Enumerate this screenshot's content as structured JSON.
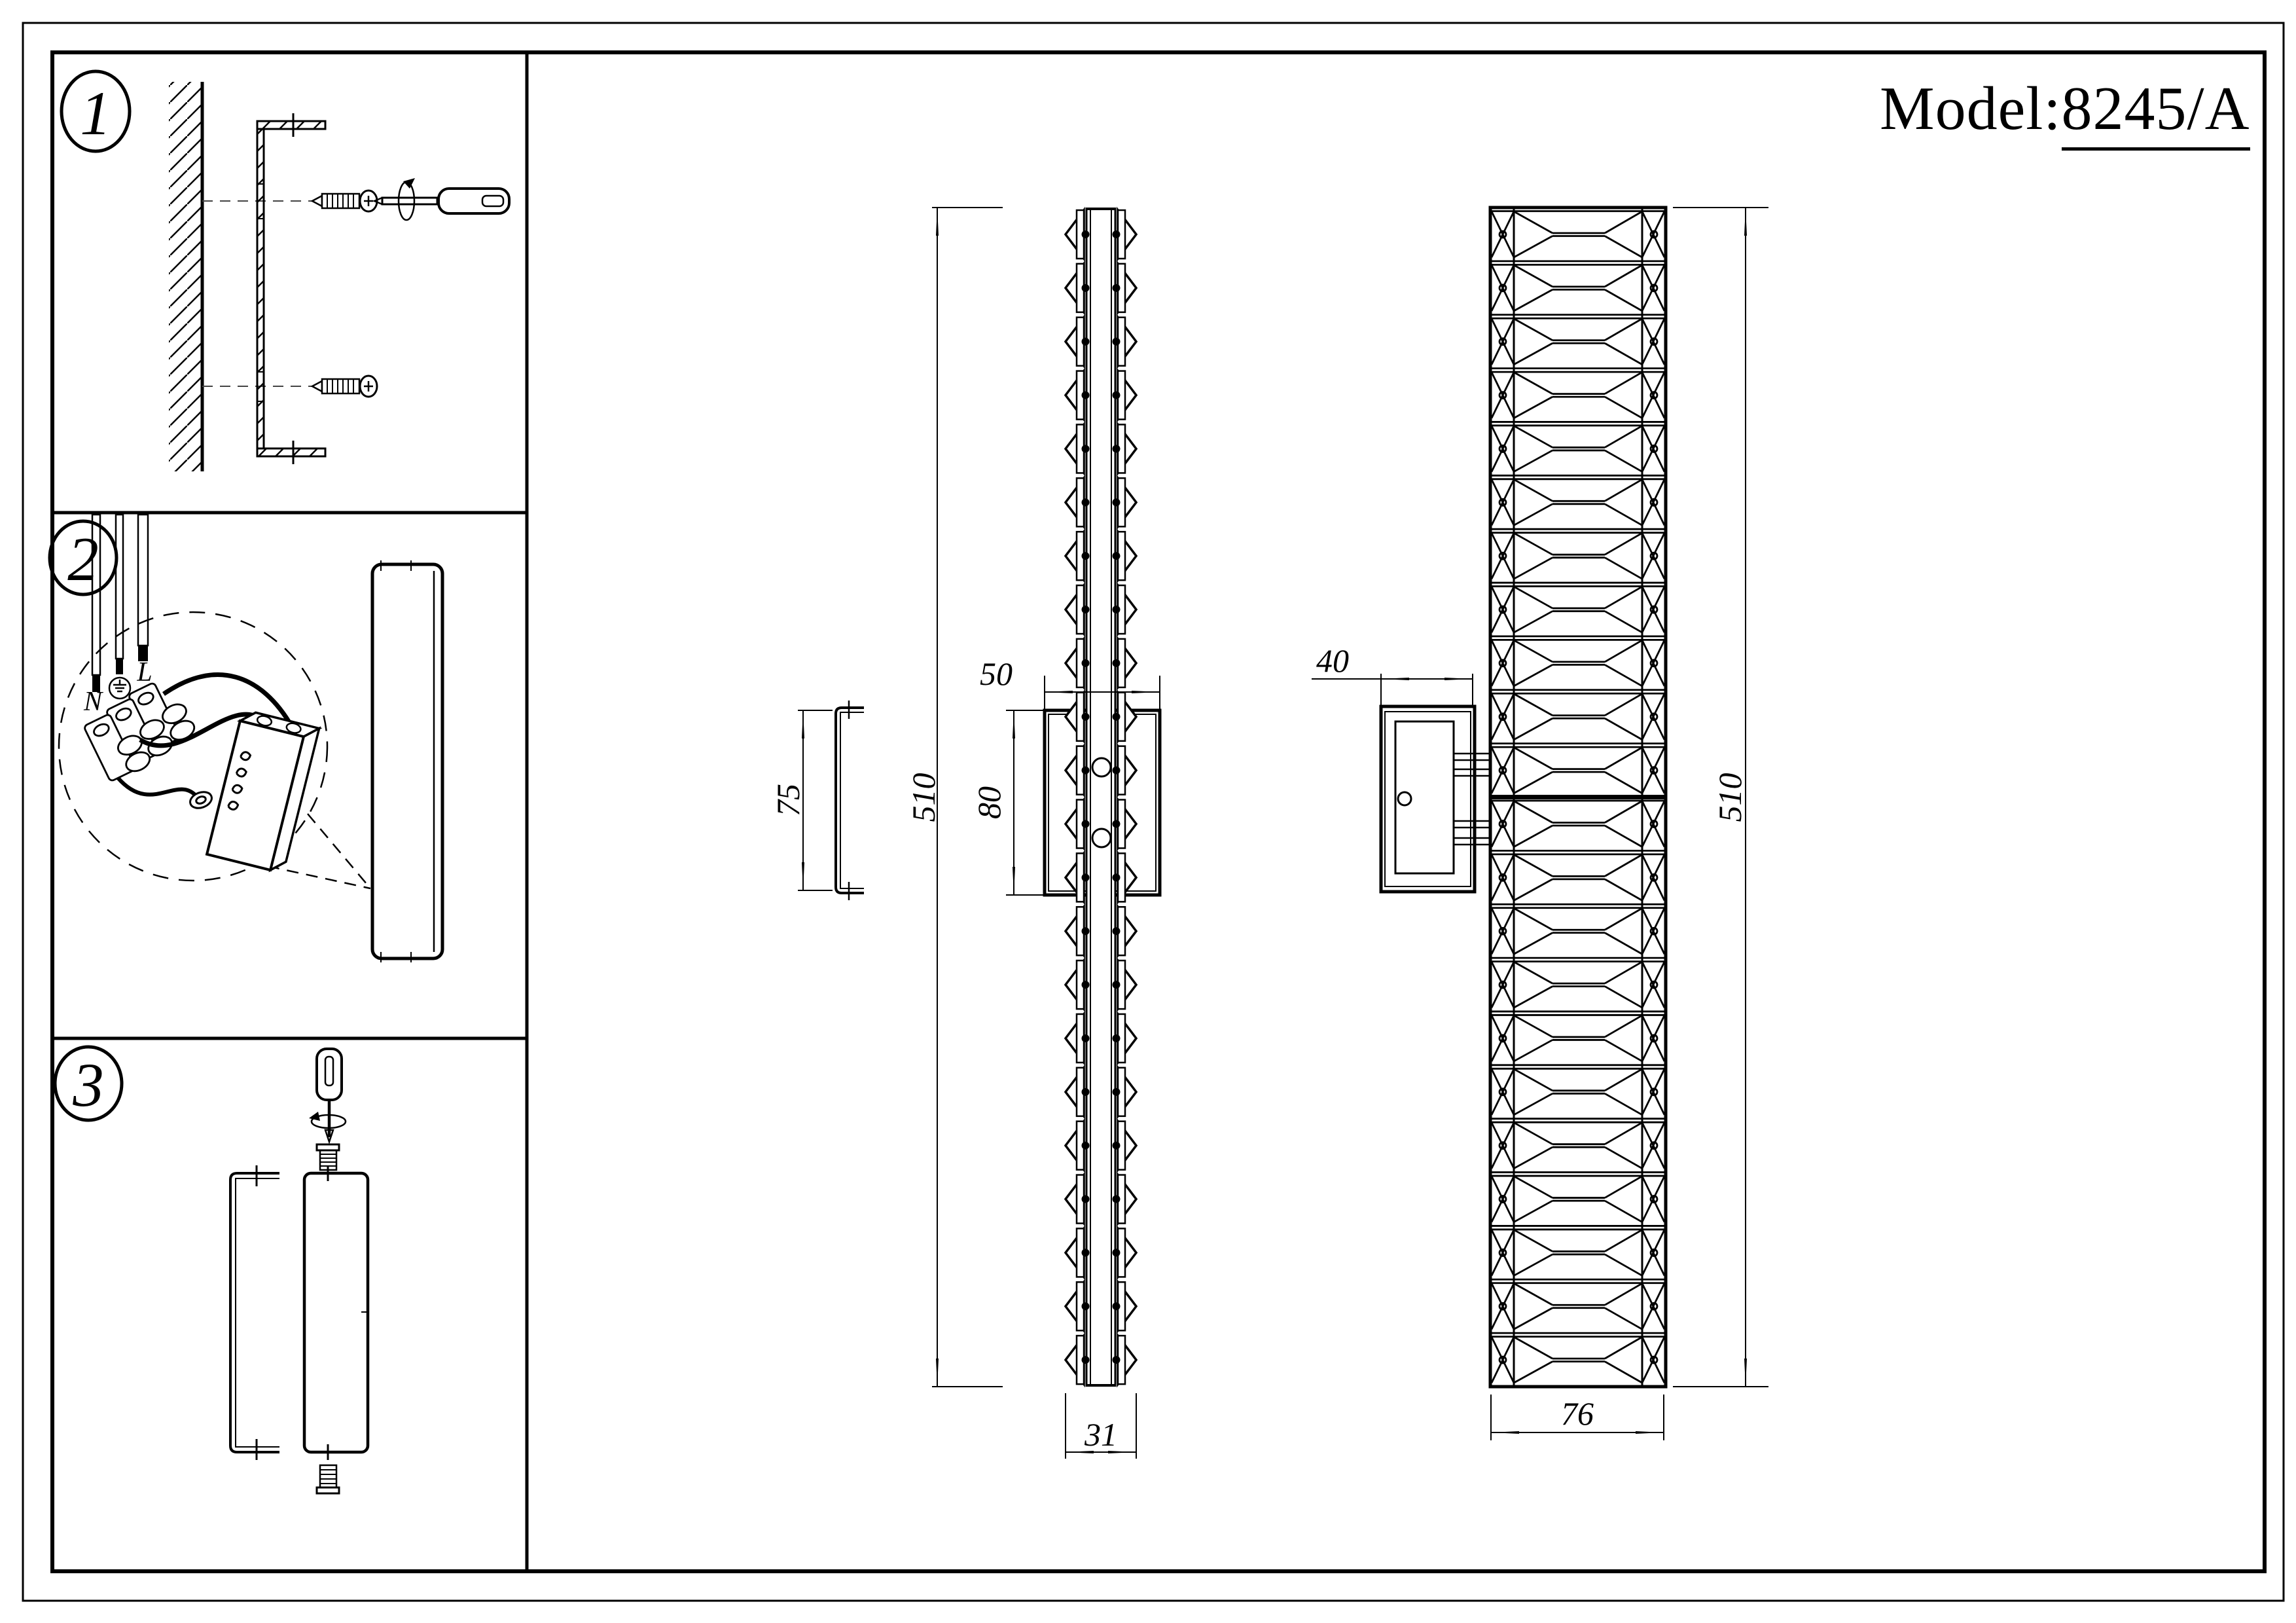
{
  "page": {
    "background": "#ffffff",
    "line_color": "#000000"
  },
  "title": {
    "label": "Model:",
    "model": "8245/A"
  },
  "steps": [
    {
      "num": "1"
    },
    {
      "num": "2"
    },
    {
      "num": "3"
    }
  ],
  "wiring": {
    "neutral": "N",
    "live": "L"
  },
  "dimensions": {
    "side_height": "510",
    "plate_width": "50",
    "plate_height": "80",
    "bracket_height": "75",
    "side_depth": "31",
    "box_depth": "40",
    "front_height": "510",
    "front_width": "76"
  },
  "views": {
    "side": {
      "segments": 22
    },
    "front": {
      "segments": 22
    }
  }
}
